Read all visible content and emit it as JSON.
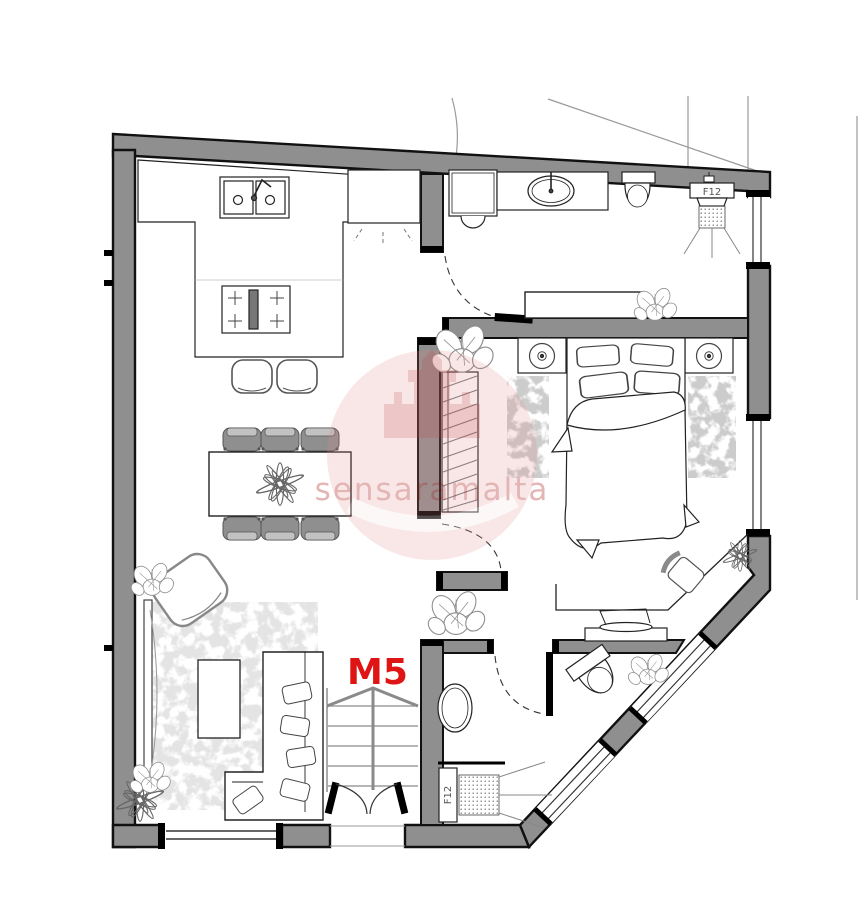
{
  "plan": {
    "unit_label": "M5",
    "shower_label_top": "F12",
    "shower_label_bottom": "F12",
    "watermark_text": "sensaramalta",
    "colors": {
      "wall_gray": "#8f8f8f",
      "line_black": "#1a1a1a",
      "accent_red": "#df1414",
      "watermark_pink": "#d98f8f",
      "rug_light": "#e4e4e4",
      "rug_dark": "#cccccc",
      "furniture_gray": "#8a8a8a",
      "tinted_cap_maroon": "#4a1d1d"
    }
  }
}
